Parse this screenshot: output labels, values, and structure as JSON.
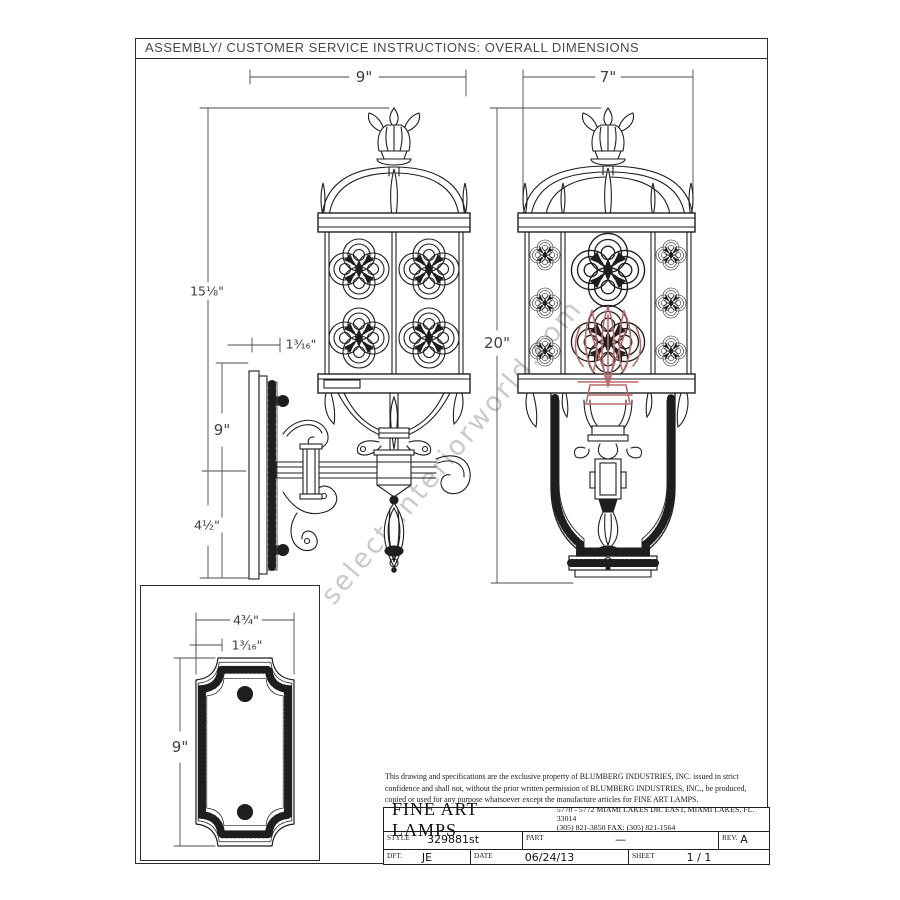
{
  "header": {
    "title": "ASSEMBLY/ CUSTOMER SERVICE  INSTRUCTIONS: OVERALL DIMENSIONS"
  },
  "watermark": {
    "text": "select-interiorworld.com"
  },
  "dimensions": {
    "side_view": {
      "width": "9\"",
      "height": "15⅛\"",
      "wall_offset": "1³⁄₁₆\"",
      "backplate_height": "9\"",
      "lower_height": "4½\""
    },
    "front_view": {
      "width": "7\"",
      "height": "20\""
    },
    "backplate": {
      "width": "4¾\"",
      "hole_offset": "1³⁄₁₆\"",
      "height": "9\""
    }
  },
  "title_block": {
    "legal_lines": [
      "This drawing and specifications are the exclusive property of BLUMBERG INDUSTRIES, INC. issued in strict",
      "confidence and shall not, without the prior written permission of BLUMBERG INDUSTRIES, INC., be produced,",
      "copied or used for any purpose whatsoever except the manufacture articles for FINE ART LAMPS."
    ],
    "company": "FINE ART LAMPS",
    "address_line1": "5770 - 5772 MIAMI LAKES DR. EAST, MIAMI LAKES, FL.  33014",
    "address_line2": "(305) 821-3850  FAX:  (305) 821-1564",
    "style_label": "STYLE",
    "style_value": "329881st",
    "part_label": "PART",
    "part_value": "—",
    "rev_label": "REV.",
    "rev_value": "A",
    "dft_label": "DFT.",
    "dft_value": "JE",
    "date_label": "DATE",
    "date_value": "06/24/13",
    "sheet_label": "SHEET",
    "sheet_value": "1  /  1"
  },
  "colors": {
    "line": "#1e1e1e",
    "dimension": "#3f3f3f",
    "accent_red": "#b96a6a",
    "watermark_gray": "#bdbdbd"
  }
}
